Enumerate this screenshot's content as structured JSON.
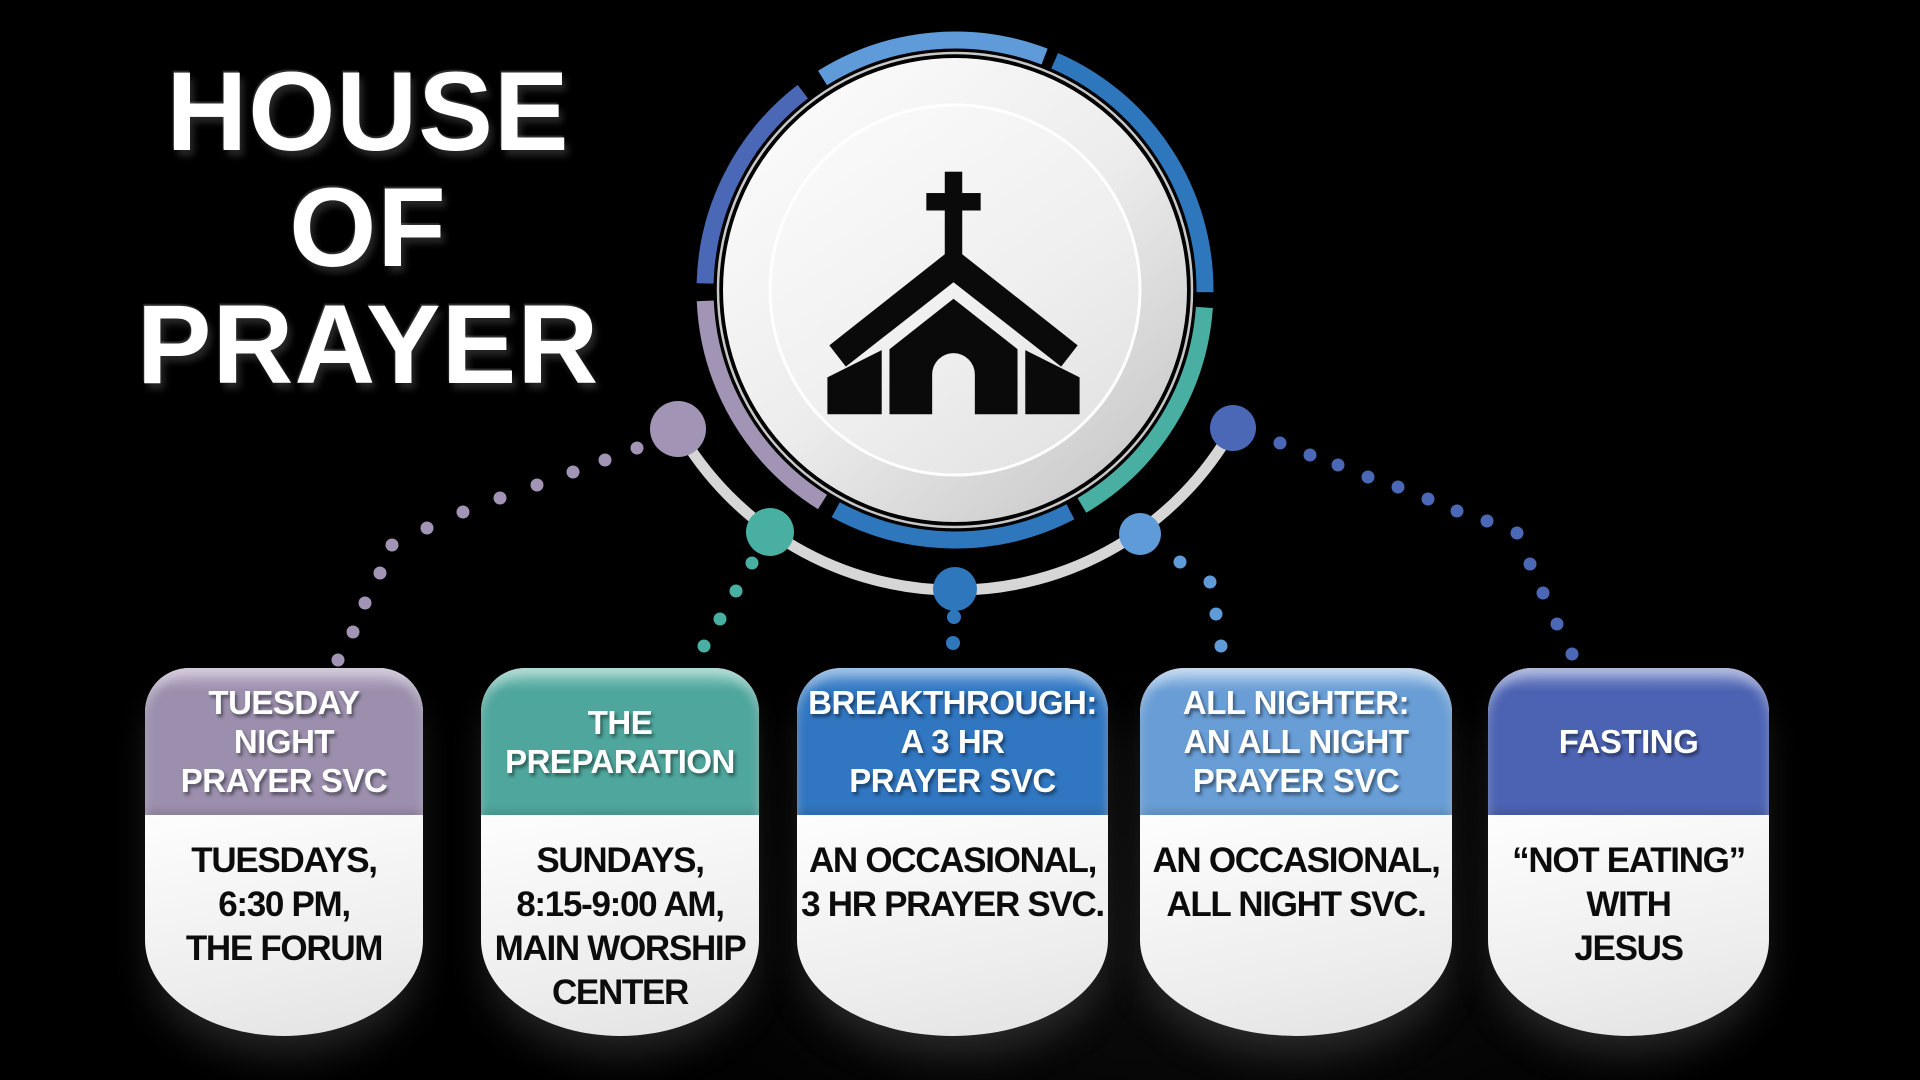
{
  "title": {
    "text": "HOUSE\nOF\nPRAYER"
  },
  "palette": {
    "purple": "#a294b4",
    "teal": "#4aafa3",
    "blue": "#2e77bd",
    "light_blue": "#5f9bd8",
    "indigo": "#4a68b5",
    "ring_gray": "#d6d6d6",
    "disc_rim": "#c8c8c8",
    "church_icon": "#0a0a0a",
    "card_text": "#0c0c0c",
    "background": "#000000"
  },
  "hub": {
    "icon": "church-icon"
  },
  "diagram": {
    "arc_ring": {
      "cx": 955,
      "cy": 290,
      "r": 250,
      "width": 17,
      "segments": [
        {
          "color": "light_blue",
          "from": -32,
          "to": 21
        },
        {
          "color": "blue",
          "from": 23.5,
          "to": 90.5
        },
        {
          "color": "teal",
          "from": 94,
          "to": 149.5
        },
        {
          "color": "blue",
          "from": 152.5,
          "to": 208.5
        },
        {
          "color": "purple",
          "from": 212,
          "to": 267.5
        },
        {
          "color": "indigo",
          "from": 271.5,
          "to": 322.5
        }
      ]
    },
    "orbit": {
      "x1": 678,
      "y1": 429,
      "x2": 1233,
      "y2": 428,
      "r": 319,
      "color": "ring_gray",
      "width": 11
    },
    "nodes": [
      {
        "color": "purple",
        "x": 678,
        "y": 429,
        "r": 28
      },
      {
        "color": "teal",
        "x": 770,
        "y": 532,
        "r": 24
      },
      {
        "color": "blue",
        "x": 955,
        "y": 589,
        "r": 22
      },
      {
        "color": "light_blue",
        "x": 1140,
        "y": 534,
        "r": 21
      },
      {
        "color": "indigo",
        "x": 1233,
        "y": 428,
        "r": 23
      }
    ],
    "connectors": [
      {
        "color": "purple",
        "dot_r": 6.5,
        "dots": [
          [
            637,
            448
          ],
          [
            605,
            460
          ],
          [
            573,
            472
          ],
          [
            537,
            485
          ],
          [
            500,
            498
          ],
          [
            463,
            512
          ],
          [
            427,
            528
          ],
          [
            392,
            545
          ],
          [
            380,
            573
          ],
          [
            365,
            603
          ],
          [
            353,
            632
          ],
          [
            338,
            660
          ]
        ]
      },
      {
        "color": "teal",
        "dot_r": 6.5,
        "dots": [
          [
            752,
            563
          ],
          [
            736,
            591
          ],
          [
            720,
            619
          ],
          [
            704,
            646
          ]
        ]
      },
      {
        "color": "blue",
        "dot_r": 7,
        "dots": [
          [
            954,
            617
          ],
          [
            953,
            643
          ]
        ]
      },
      {
        "color": "light_blue",
        "dot_r": 6.5,
        "dots": [
          [
            1180,
            562
          ],
          [
            1210,
            582
          ],
          [
            1216,
            614
          ],
          [
            1221,
            646
          ]
        ]
      },
      {
        "color": "indigo",
        "dot_r": 6.5,
        "dots": [
          [
            1280,
            443
          ],
          [
            1310,
            455
          ],
          [
            1338,
            465
          ],
          [
            1368,
            477
          ],
          [
            1398,
            487
          ],
          [
            1428,
            499
          ],
          [
            1457,
            511
          ],
          [
            1487,
            521
          ],
          [
            1517,
            533
          ],
          [
            1530,
            564
          ],
          [
            1543,
            593
          ],
          [
            1557,
            624
          ],
          [
            1572,
            654
          ]
        ]
      }
    ]
  },
  "cards": [
    {
      "id": "tuesday-night-prayer-svc",
      "x": 145,
      "width": 278,
      "header_color": "#9b8fad",
      "header_light": "#bcb1c9",
      "title": "TUESDAY\nNIGHT\nPRAYER SVC",
      "body": "TUESDAYS,\n6:30 PM,\nTHE FORUM"
    },
    {
      "id": "the-preparation",
      "x": 481,
      "width": 278,
      "header_color": "#4ea69c",
      "header_light": "#88c9c0",
      "title": "THE\nPREPARATION",
      "body": "SUNDAYS,\n8:15-9:00 AM,\nMAIN WORSHIP\nCENTER"
    },
    {
      "id": "breakthrough-3hr-prayer-svc",
      "x": 797,
      "width": 311,
      "header_color": "#3076c1",
      "header_light": "#6ea3db",
      "title": "BREAKTHROUGH:\nA 3 HR\nPRAYER SVC",
      "body": "AN OCCASIONAL,\n3 HR PRAYER SVC."
    },
    {
      "id": "all-nighter-prayer-svc",
      "x": 1140,
      "width": 312,
      "header_color": "#689dd5",
      "header_light": "#a7c7e9",
      "title": "ALL NIGHTER:\nAN ALL NIGHT\nPRAYER SVC",
      "body": "AN OCCASIONAL,\nALL NIGHT SVC."
    },
    {
      "id": "fasting",
      "x": 1488,
      "width": 281,
      "header_color": "#4c63b3",
      "header_light": "#8896ce",
      "title": "FASTING",
      "body": "“NOT EATING”\nWITH\nJESUS"
    }
  ]
}
